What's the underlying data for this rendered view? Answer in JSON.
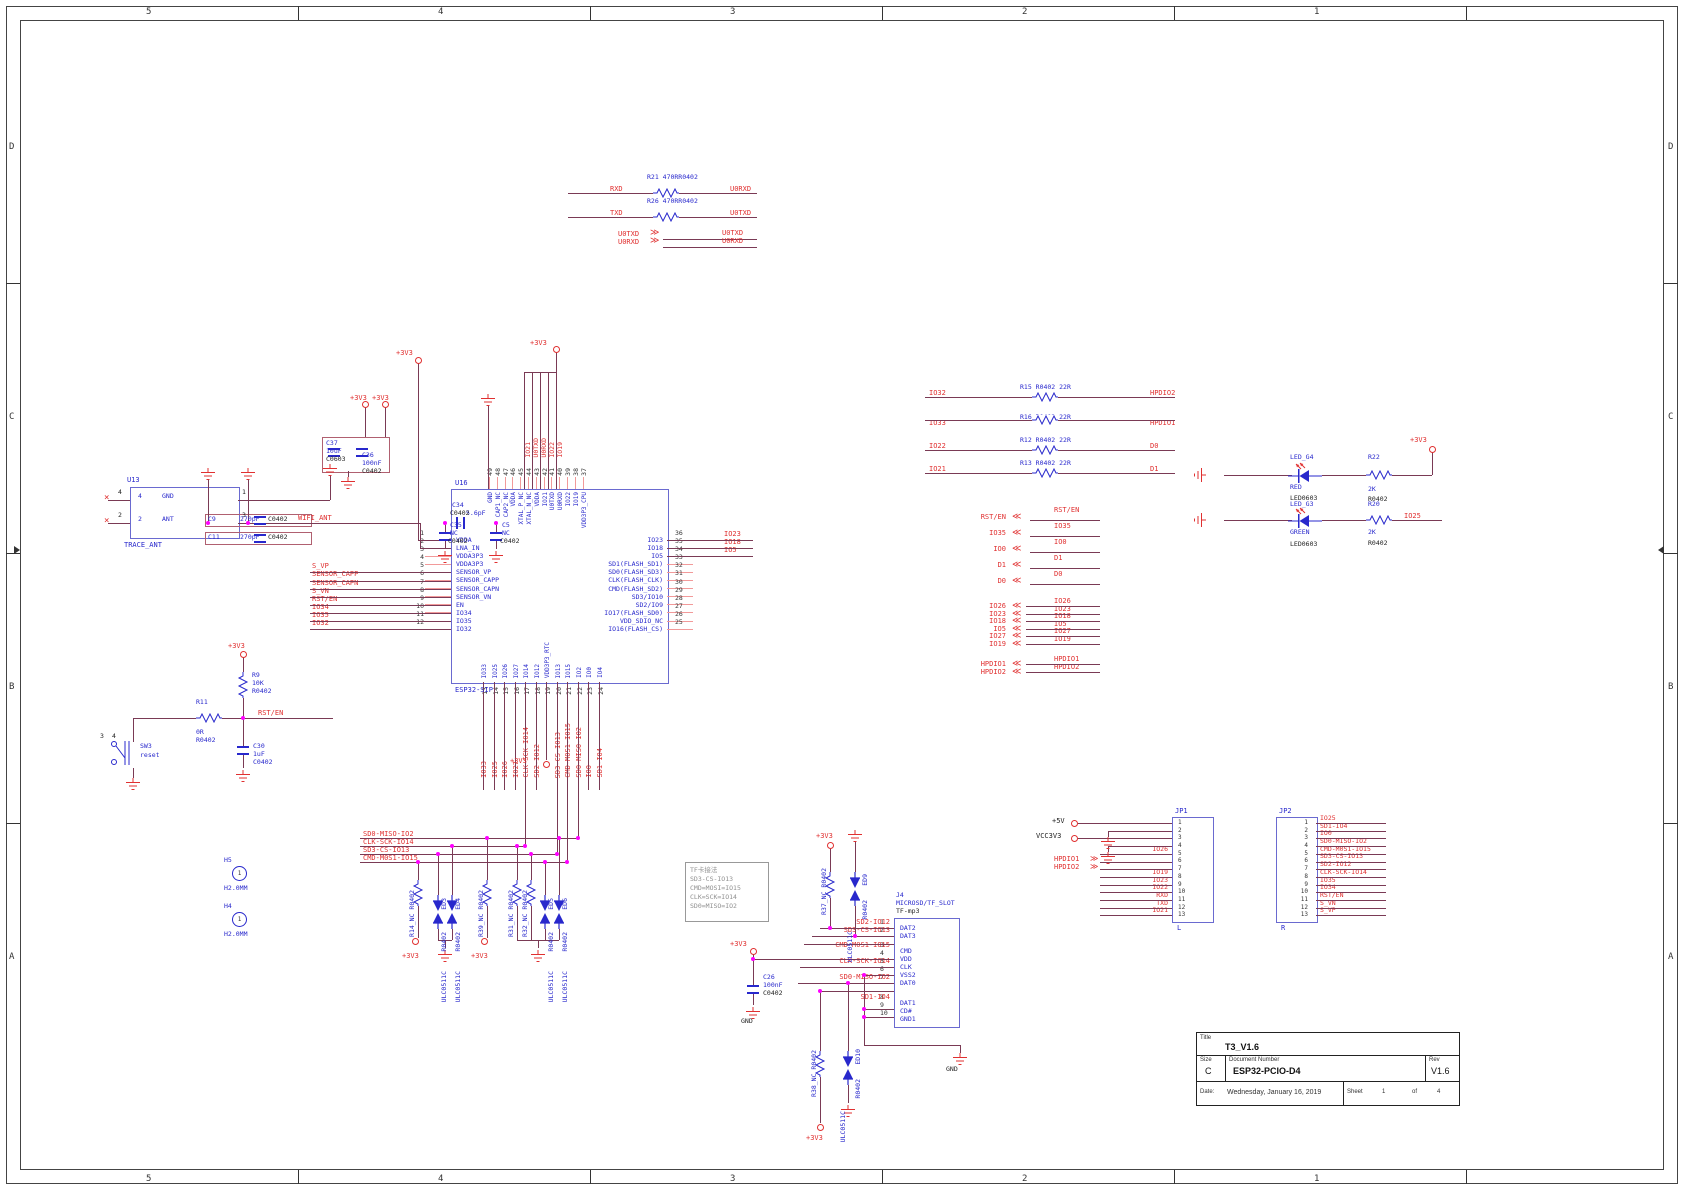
{
  "sheet": {
    "zones_x": [
      {
        "t": "5",
        "c": "zx1"
      },
      {
        "t": "4",
        "c": "zx2"
      },
      {
        "t": "3",
        "c": "zx3"
      },
      {
        "t": "2",
        "c": "zx4"
      },
      {
        "t": "1",
        "c": "zx5"
      }
    ],
    "zones_y": [
      {
        "t": "D",
        "c": "zy1"
      },
      {
        "t": "C",
        "c": "zy2"
      },
      {
        "t": "B",
        "c": "zy3"
      },
      {
        "t": "A",
        "c": "zy4"
      }
    ]
  },
  "title_block": {
    "title_label": "Title",
    "title": "T3_V1.6",
    "size_label": "Size",
    "size": "C",
    "doc_label": "Document Number",
    "doc_number": "ESP32-PCIO-D4",
    "rev_label": "Rev",
    "rev": "V1.6",
    "date_label": "Date:",
    "date": "Wednesday, January 16, 2019",
    "sheet_label": "Sheet",
    "sheet_num": "1",
    "of_label": "of",
    "sheet_total": "4"
  },
  "uart": {
    "rxd": "RXD",
    "txd": "TXD",
    "u0rxd": "U0RXD",
    "u0txd": "U0TXD",
    "r21": "R21  470RR0402",
    "r26": "R26  470RR0402",
    "bus_left_txd": "U0TXD",
    "bus_left_rxd": "U0RXD",
    "bus_right_txd": "U0TXD",
    "bus_right_rxd": "U0RXD"
  },
  "esp32": {
    "ref": "U16",
    "part": "ESP32-SIP",
    "pwr": "+3V3",
    "pwr2": "+3V3",
    "pwr3": "+3V3",
    "top_pins": [
      {
        "n": "49",
        "name": "GND"
      },
      {
        "n": "48",
        "name": "CAP1_NC"
      },
      {
        "n": "47",
        "name": "CAP2_NC"
      },
      {
        "n": "46",
        "name": "VDDA"
      },
      {
        "n": "45",
        "name": "XTAL_P_NC"
      },
      {
        "n": "44",
        "name": "XTAL_N_NC"
      },
      {
        "n": "43",
        "name": "VDDA"
      },
      {
        "n": "42",
        "name": "IO21"
      },
      {
        "n": "41",
        "name": "U0TXD"
      },
      {
        "n": "40",
        "name": "U0RXD"
      },
      {
        "n": "39",
        "name": "IO22"
      },
      {
        "n": "38",
        "name": "IO19"
      },
      {
        "n": "37",
        "name": "VDD3P3_CPU"
      }
    ],
    "top_nets": [
      "IO21",
      "U0TXD",
      "U0RXD",
      "IO22",
      "IO19"
    ],
    "left_pins": [
      {
        "n": "1",
        "name": "VDDA"
      },
      {
        "n": "2",
        "name": "LNA_IN"
      },
      {
        "n": "3",
        "name": "VDDA3P3"
      },
      {
        "n": "4",
        "name": "VDDA3P3"
      },
      {
        "n": "5",
        "name": "SENSOR_VP"
      },
      {
        "n": "6",
        "name": "SENSOR_CAPP"
      },
      {
        "n": "7",
        "name": "SENSOR_CAPN"
      },
      {
        "n": "8",
        "name": "SENSOR_VN"
      },
      {
        "n": "9",
        "name": "EN"
      },
      {
        "n": "10",
        "name": "IO34"
      },
      {
        "n": "11",
        "name": "IO35"
      },
      {
        "n": "12",
        "name": "IO32"
      }
    ],
    "left_nets": [
      "",
      "",
      "",
      "",
      "S_VP",
      "SENSOR_CAPP",
      "SENSOR_CAPN",
      "S_VN",
      "RST/EN",
      "IO34",
      "IO35",
      "IO32"
    ],
    "right_pins": [
      {
        "n": "36",
        "name": "IO23"
      },
      {
        "n": "35",
        "name": "IO18"
      },
      {
        "n": "34",
        "name": "IO5"
      },
      {
        "n": "33",
        "name": "SD1(FLASH_SD1)"
      },
      {
        "n": "32",
        "name": "SD0(FLASH_SD3)"
      },
      {
        "n": "31",
        "name": "CLK(FLASH_CLK)"
      },
      {
        "n": "30",
        "name": "CMD(FLASH_SD2)"
      },
      {
        "n": "29",
        "name": "SD3/IO10"
      },
      {
        "n": "28",
        "name": "SD2/IO9"
      },
      {
        "n": "27",
        "name": "IO17(FLASH_SD0)"
      },
      {
        "n": "26",
        "name": "VDD_SDIO_NC"
      },
      {
        "n": "25",
        "name": "IO16(FLASH_CS)"
      }
    ],
    "right_nets": [
      "IO23",
      "IO18",
      "IO5",
      "",
      "",
      "",
      "",
      "",
      "",
      "",
      "",
      ""
    ],
    "bottom_pins": [
      {
        "n": "13",
        "name": "IO33"
      },
      {
        "n": "14",
        "name": "IO25"
      },
      {
        "n": "15",
        "name": "IO26"
      },
      {
        "n": "16",
        "name": "IO27"
      },
      {
        "n": "17",
        "name": "IO14"
      },
      {
        "n": "18",
        "name": "IO12"
      },
      {
        "n": "19",
        "name": "VDD3P3_RTC"
      },
      {
        "n": "20",
        "name": "IO13"
      },
      {
        "n": "21",
        "name": "IO15"
      },
      {
        "n": "22",
        "name": "IO2"
      },
      {
        "n": "23",
        "name": "IO0"
      },
      {
        "n": "24",
        "name": "IO4"
      }
    ],
    "bottom_nets": [
      "IO33",
      "IO25",
      "IO26",
      "IO27",
      "CLK-SCK-IO14",
      "SD2-IO12",
      "",
      "SD3-CS-IO13",
      "CMD-M0S1-IO15",
      "SD0-MISO-IO2",
      "IO0",
      "SD1-IO4"
    ]
  },
  "antenna": {
    "ref": "U13",
    "part": "TRACE_ANT",
    "net": "WIFI_ANT",
    "pin_gnd_num": "4",
    "pin_gnd": "GND",
    "pin_ant_num": "2",
    "pin_ant": "ANT",
    "out1": "1",
    "out2": "2",
    "out3": "3",
    "out4": "4",
    "c35_ref": "C35",
    "c35_val": "NC",
    "c35_pkg": "C0402",
    "c34_ref": "C34",
    "c34_val": "5.6pF",
    "c34_pkg": "C0402",
    "c5_ref": "C5",
    "c5_val": "NC",
    "c5_pkg": "C0402",
    "c9_ref": "C9",
    "c9_val": "270pF",
    "c9_pkg": "C0402",
    "c11_ref": "C11",
    "c11_val": "270pF",
    "c11_pkg": "C0402",
    "c37_ref": "C37",
    "c37_val": "10uF",
    "c37_pkg": "C0603",
    "c36_ref": "C36",
    "c36_val": "100nF",
    "c36_pkg": "C0402",
    "pwr": "+3V3",
    "pwr2": "+3V3"
  },
  "reset": {
    "sw_ref": "SW3",
    "sw_label": "reset",
    "sw_pin3": "3",
    "sw_pin4": "4",
    "r9_ref": "R9",
    "r9_val": "10K",
    "r9_pkg": "R0402",
    "r11_ref": "R11",
    "r11_val": "0R",
    "r11_pkg": "R0402",
    "c30_ref": "C30",
    "c30_val": "1uF",
    "c30_pkg": "C0402",
    "net": "RST/EN",
    "pwr": "+3V3"
  },
  "series22": [
    {
      "left": "IO32",
      "label": "R15  R0402  22R",
      "right": "HPDIO2"
    },
    {
      "left": "IO33",
      "label": "R16  R0402  22R",
      "right": "HPDIO1"
    },
    {
      "left": "IO22",
      "label": "R12  R0402  22R",
      "right": "D0"
    },
    {
      "left": "IO21",
      "label": "R13  R0402  22R",
      "right": "D1"
    }
  ],
  "leds": [
    {
      "ref": "LED_G4",
      "color": "RED",
      "pkg": "LED0603",
      "rref": "R22",
      "rval": "2K",
      "rpkg": "R0402",
      "net": "+3V3"
    },
    {
      "ref": "LED_G3",
      "color": "GREEN",
      "pkg": "LED0603",
      "rref": "R20",
      "rval": "2K",
      "rpkg": "R0402",
      "net": "IO25"
    }
  ],
  "arrows_a": [
    {
      "l": "RST/EN",
      "r": "RST/EN"
    },
    {
      "l": "IO35",
      "r": "IO35"
    },
    {
      "l": "IO0",
      "r": "IO0"
    },
    {
      "l": "D1",
      "r": "D1"
    },
    {
      "l": "D0",
      "r": "D0"
    }
  ],
  "arrows_b": [
    {
      "l": "IO26",
      "r": "IO26"
    },
    {
      "l": "IO23",
      "r": "IO23"
    },
    {
      "l": "IO18",
      "r": "IO18"
    },
    {
      "l": "IO5",
      "r": "IO5"
    },
    {
      "l": "IO27",
      "r": "IO27"
    },
    {
      "l": "IO19",
      "r": "IO19"
    }
  ],
  "arrows_c": [
    {
      "l": "HPDIO1",
      "r": "HPDIO1"
    },
    {
      "l": "HPDIO2",
      "r": "HPDIO2"
    }
  ],
  "jp1": {
    "ref": "JP1",
    "tag": "L",
    "p5v": "+5V",
    "vcc": "VCC3V3",
    "hp1": "HPDIO1",
    "hp2": "HPDIO2",
    "pins": [
      {
        "n": "1",
        "net": ""
      },
      {
        "n": "2",
        "net": ""
      },
      {
        "n": "3",
        "net": ""
      },
      {
        "n": "4",
        "net": ""
      },
      {
        "n": "5",
        "net": "IO26"
      },
      {
        "n": "6",
        "net": ""
      },
      {
        "n": "7",
        "net": ""
      },
      {
        "n": "8",
        "net": "IO19"
      },
      {
        "n": "9",
        "net": "IO23"
      },
      {
        "n": "10",
        "net": "IO22"
      },
      {
        "n": "11",
        "net": "RXD"
      },
      {
        "n": "12",
        "net": "TXD"
      },
      {
        "n": "13",
        "net": "IO21"
      }
    ]
  },
  "jp2": {
    "ref": "JP2",
    "tag": "R",
    "pins": [
      {
        "n": "1",
        "net": "IO25"
      },
      {
        "n": "2",
        "net": "SD1-IO4"
      },
      {
        "n": "3",
        "net": "IO0"
      },
      {
        "n": "4",
        "net": "SD0-MISO-IO2"
      },
      {
        "n": "5",
        "net": "CMD-M0S1-IO15"
      },
      {
        "n": "6",
        "net": "SD3-CS-IO13"
      },
      {
        "n": "7",
        "net": "SD2-IO12"
      },
      {
        "n": "8",
        "net": "CLK-SCK-IO14"
      },
      {
        "n": "9",
        "net": "IO35"
      },
      {
        "n": "10",
        "net": "IO34"
      },
      {
        "n": "11",
        "net": "RST/EN"
      },
      {
        "n": "12",
        "net": "S_VN"
      },
      {
        "n": "13",
        "net": "S_VP"
      }
    ]
  },
  "j4": {
    "ref": "J4",
    "part": "MICROSD/TF_SLOT",
    "sub": "TF-mp3",
    "gnd": "GND",
    "pwr": "+3V3",
    "pins": [
      {
        "n": "1",
        "name": "DAT2",
        "net": "SD2-IO12"
      },
      {
        "n": "2",
        "name": "DAT3",
        "net": "SD3-CS-IO13"
      },
      {
        "n": "3",
        "name": "CMD",
        "net": "CMD-M0S1-IO15"
      },
      {
        "n": "4",
        "name": "VDD",
        "net": ""
      },
      {
        "n": "5",
        "name": "CLK",
        "net": "CLK-SCK-IO14"
      },
      {
        "n": "6",
        "name": "VSS2",
        "net": ""
      },
      {
        "n": "7",
        "name": "DAT0",
        "net": "SD0-MISO-IO2"
      },
      {
        "n": "8",
        "name": "DAT1",
        "net": "SD1-IO4"
      },
      {
        "n": "9",
        "name": "CD#",
        "net": ""
      },
      {
        "n": "10",
        "name": "GND1",
        "net": ""
      }
    ]
  },
  "c26": {
    "ref": "C26",
    "val": "100nF",
    "pkg": "C0402",
    "gnd": "GND"
  },
  "tvs_top": {
    "r_ref": "R37_NC  R0402",
    "ed_ref": "ED9",
    "ed_pkg": "R0402",
    "ed_part": "ULC0511C",
    "pwr": "+3V3"
  },
  "tvs_bot": {
    "r_ref": "R38_NC  R0402",
    "ed_ref": "ED10",
    "ed_pkg": "R0402",
    "ed_part": "ULC0511C",
    "pwr": "+3V3"
  },
  "esd": {
    "bus": [
      "SD0-MISO-IO2",
      "CLK-SCK-IO14",
      "SD3-CS-IO13",
      "CMD-M0S1-IO15"
    ],
    "r14": "R14_NC  R0402",
    "r39": "R39_NC  R0402",
    "r31": "R31_NC  R0402",
    "r32": "R32_NC  R0402",
    "ed3": "ED3",
    "ed4": "ED4",
    "ed5": "ED5",
    "ed6": "ED6",
    "ulc": "ULC0511C",
    "pkg": "R0402",
    "pwr1": "+3V3",
    "pwr2": "+3V3"
  },
  "mount": [
    {
      "ref": "H5",
      "pin": "1",
      "size": "H2.0MM"
    },
    {
      "ref": "H4",
      "pin": "1",
      "size": "H2.0MM"
    }
  ],
  "note": {
    "lines": [
      "TF卡接法",
      "SD3-CS-IO13",
      "CMD=MOSI=IO15",
      "CLK=SCK=IO14",
      "SD0=MISO=IO2"
    ]
  },
  "colors": {
    "wire": "#7a3a55",
    "net_label": "#e03030",
    "component": "#2828cc",
    "junction": "#ff00ff"
  }
}
